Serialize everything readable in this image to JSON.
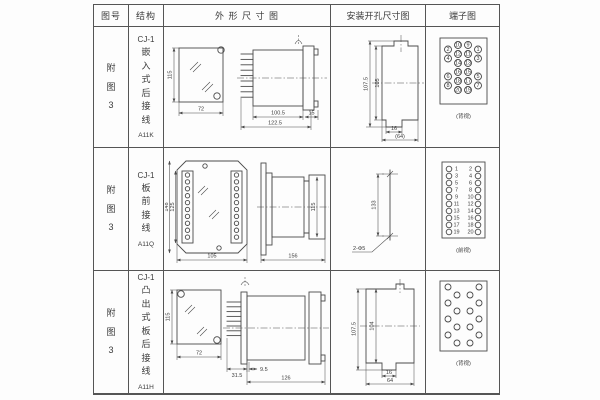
{
  "table": {
    "header": {
      "fig_no": "图号",
      "structure": "结构",
      "outline": "外 形 尺 寸 图",
      "mounting": "安装开孔尺寸图",
      "terminal": "端子图"
    }
  },
  "rows": [
    {
      "fig_no": "附图3",
      "model": "CJ-1",
      "desc": "嵌入式后接线",
      "code": "A11K",
      "outline": {
        "front_h": "115",
        "front_w": "72",
        "depth": "100.5",
        "overall": "122.5",
        "flange": "15"
      },
      "mounting": {
        "outer_h": "107.5",
        "inner_h": "105",
        "notch_w": "16",
        "overall_w": "(64)"
      },
      "terminal_label": "(背视)"
    },
    {
      "fig_no": "附图3",
      "model": "CJ-1",
      "desc": "板前接线",
      "code": "A11Q",
      "outline": {
        "plate_h": "148",
        "window_h": "125",
        "plate_w": "105",
        "length": "156",
        "body_h": "115"
      },
      "mounting": {
        "hole_span": "133",
        "hole_note": "2-Φ5"
      },
      "terminal_label": "(前视)"
    },
    {
      "fig_no": "附图3",
      "model": "CJ-1",
      "desc": "凸出式板后接线",
      "code": "A11H",
      "outline": {
        "front_h": "115",
        "front_w": "72",
        "fin_d": "31.5",
        "gap": "9.5",
        "body_d": "126"
      },
      "mounting": {
        "outer_h": "107.5",
        "inner_h": "104",
        "notch_w": "16",
        "overall_w": "64"
      },
      "terminal_label": "(背视)"
    }
  ],
  "terminals": {
    "row1": {
      "inner_left": [
        "10",
        "12",
        "14",
        "16",
        "18",
        "20"
      ],
      "inner_right": [
        "9",
        "11",
        "13",
        "15",
        "17",
        "19"
      ],
      "outer_left": [
        "2",
        "4",
        "6",
        "8"
      ],
      "outer_right": [
        "1",
        "3",
        "5",
        "7"
      ]
    },
    "row2": {
      "left": [
        "1",
        "3",
        "5",
        "7",
        "9",
        "11",
        "13",
        "15",
        "17",
        "19"
      ],
      "right": [
        "2",
        "4",
        "6",
        "8",
        "10",
        "12",
        "14",
        "16",
        "18",
        "20"
      ]
    },
    "row3": {
      "circles_per_side": 8
    }
  },
  "colors": {
    "line": "#4a4a4a",
    "text": "#3b3b3b",
    "bg": "#fdfdfd"
  }
}
